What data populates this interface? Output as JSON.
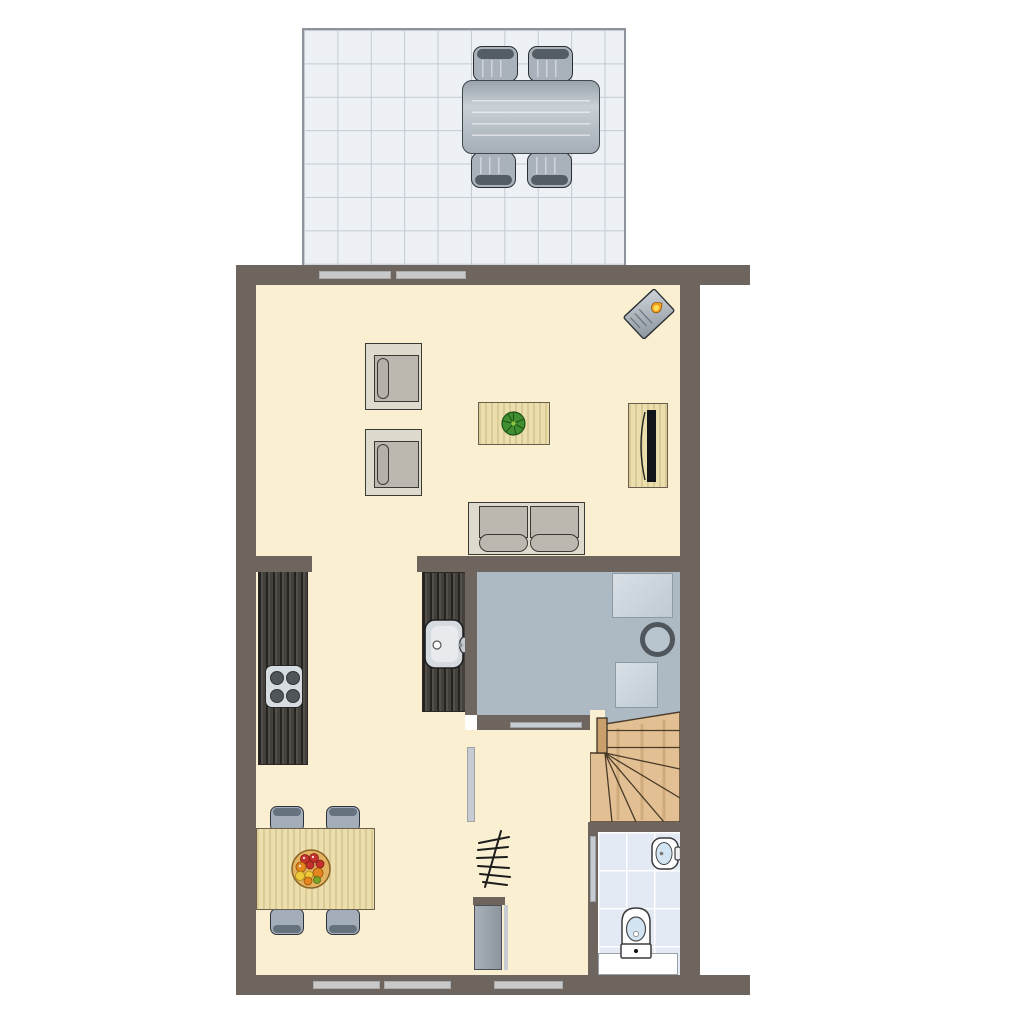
{
  "document": {
    "kind": "architectural floor plan, top-down view, no text labels"
  },
  "colors": {
    "wall": "#6E655F",
    "floor": "#FAF0D1",
    "terraceTile": "#EDF0F4",
    "terraceLine": "#C3CAD3",
    "terraceBorder": "#8E949C",
    "utilityFloor": "#ADBAC4",
    "bathTile": "#E3EAF3",
    "woodFurniture": "#ECDFAE",
    "woodStairs": "#E2C093",
    "stairsLine": "#4A3B29",
    "counter": "#44403C",
    "windowStrip": "#C9C9C9",
    "doorStrip": "#C7CCD2",
    "doorLeaf": "#9AA3AD",
    "seatFrame": "#DEDBCE",
    "cushion": "#BCB8B0",
    "chairGray": "#A4AEBA",
    "chairCap": "#67727F",
    "terraceChair": "#A9B2BA",
    "terraceChairCap": "#555D64",
    "stoveTop": "#D7DCE0",
    "burner": "#50555A",
    "applianceBorder": "#8D99A3",
    "fixtureBlue": "#D3E4F2",
    "plantGreen": "#3F8F30",
    "bowl": "#E3B261",
    "fruitRed": "#C4302B",
    "fruitOrange": "#E5851F",
    "fruitYellow": "#EFC93C",
    "fruitGreen": "#7BA32A",
    "flame": "#F59B1E",
    "flameInner": "#FFDE54",
    "steelLight": "#CDD4DA",
    "steelDark": "#8C959C"
  },
  "plan": {
    "rooms": [
      {
        "id": "terrace",
        "floor": "gray tiles",
        "furniture": [
          "outdoor dining table",
          "4 outdoor chairs"
        ]
      },
      {
        "id": "living-room",
        "floor": "cream",
        "furniture": [
          "2 armchairs",
          "coffee table with plant",
          "2-seat sofa",
          "tv sideboard with tv",
          "corner wood stove"
        ]
      },
      {
        "id": "kitchen",
        "floor": "cream",
        "furniture": [
          "counter with 4-burner cooktop",
          "counter with sink"
        ]
      },
      {
        "id": "dining-area",
        "floor": "cream",
        "furniture": [
          "dining table with fruit bowl",
          "4 chairs"
        ]
      },
      {
        "id": "hallway",
        "floor": "cream",
        "furniture": [
          "coat rack",
          "front door"
        ]
      },
      {
        "id": "utility-room",
        "floor": "blue-gray",
        "furniture": [
          "2 appliances",
          "round boiler"
        ]
      },
      {
        "id": "staircase",
        "floor": "wood",
        "furniture": [
          "winder stairs with newel post"
        ]
      },
      {
        "id": "bathroom",
        "floor": "light blue tiles",
        "furniture": [
          "washbasin",
          "toilet",
          "white mat"
        ]
      }
    ],
    "openings": {
      "terrace_door_panels": 2,
      "street_side_windows": 3,
      "interior_sliding_doors": 3,
      "front_door": 1
    }
  }
}
